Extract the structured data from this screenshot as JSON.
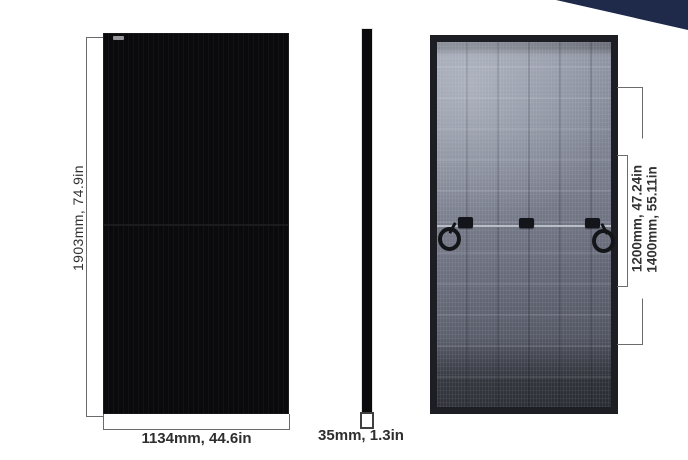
{
  "dimensions": {
    "height": {
      "label": "1903mm, 74.9in",
      "mm": 1903,
      "in": 74.9
    },
    "width": {
      "label": "1134mm, 44.6in",
      "mm": 1134,
      "in": 44.6
    },
    "thickness": {
      "label": "35mm, 1.3in",
      "mm": 35,
      "in": 1.3
    },
    "mount_inner": {
      "label": "1200mm, 47.24in",
      "mm": 1200,
      "in": 47.24
    },
    "mount_outer": {
      "label": "1400mm, 55.11in",
      "mm": 1400,
      "in": 55.11
    }
  },
  "colors": {
    "background": "#ffffff",
    "corner_accent": "#1f294a",
    "front_panel": "#0a0a0c",
    "back_panel_frame": "#1d1e23",
    "back_panel_sheet": "#858a98",
    "dimension_line": "#6b6b6b",
    "dimension_text": "#2e2e2e"
  }
}
